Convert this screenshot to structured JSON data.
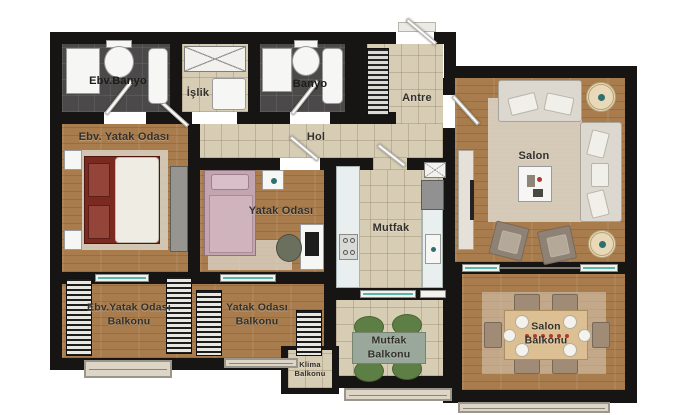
{
  "plan_title": "",
  "rooms": {
    "ebv_banyo": {
      "label": "Ebv.Banyo"
    },
    "islik": {
      "label": "İşlik"
    },
    "banyo": {
      "label": "Banyo"
    },
    "antre": {
      "label": "Antre"
    },
    "hol": {
      "label": "Hol"
    },
    "ebv_yatak": {
      "label": "Ebv. Yatak Odası"
    },
    "yatak": {
      "label": "Yatak Odası"
    },
    "mutfak": {
      "label": "Mutfak"
    },
    "salon": {
      "label": "Salon"
    },
    "ebv_balkon": {
      "label": "Ebv.Yatak Odası\nBalkonu"
    },
    "yatak_balkon": {
      "label": "Yatak Odası\nBalkonu"
    },
    "mutfak_balkon": {
      "label": "Mutfak\nBalkonu"
    },
    "salon_balkon": {
      "label": "Salon\nBalkonu"
    },
    "klima_balkon": {
      "label": "Klima\nBalkonu"
    }
  },
  "furniture_icons": {
    "ebv_banyo": [
      "shower",
      "toilet",
      "bathtub"
    ],
    "islik": [
      "x-cabinet",
      "washing-machine"
    ],
    "banyo": [
      "shower",
      "toilet",
      "bathtub"
    ],
    "antre": [
      "entry-door",
      "shoe-cabinet"
    ],
    "ebv_yatak": [
      "double-bed",
      "nightstand",
      "nightstand",
      "wardrobe",
      "rug"
    ],
    "yatak": [
      "single-bed",
      "nightstand",
      "desk",
      "chair",
      "rug"
    ],
    "mutfak": [
      "counter",
      "stove",
      "sink",
      "fridge",
      "x-cabinet"
    ],
    "salon": [
      "sofa",
      "sofa",
      "armchair",
      "armchair",
      "coffee-table",
      "tv-unit",
      "plant",
      "plant",
      "rug"
    ],
    "salon_balkon": [
      "dining-table",
      "chair",
      "chair",
      "chair",
      "chair",
      "chair",
      "chair"
    ],
    "mutfak_balkon": [
      "table",
      "green-chair",
      "green-chair",
      "green-chair",
      "green-chair"
    ],
    "balconies": [
      "louvre-panel",
      "railing",
      "glass-door"
    ]
  },
  "colors": {
    "wall": "#171513",
    "wood": "#a87c4c",
    "tile": "#d7ccb4",
    "bath": "#4b4949",
    "sofa": "#dcd8d0",
    "bed-red": "#7a2a20",
    "bed-pink": "#c3a5b0",
    "chair-green": "#5d7f46",
    "balcony-table": "#9aa89b",
    "dining-table": "#dcbf92",
    "counter": "#e9efee",
    "rug": "#d9d2c4",
    "wardrobe": "#979590"
  }
}
